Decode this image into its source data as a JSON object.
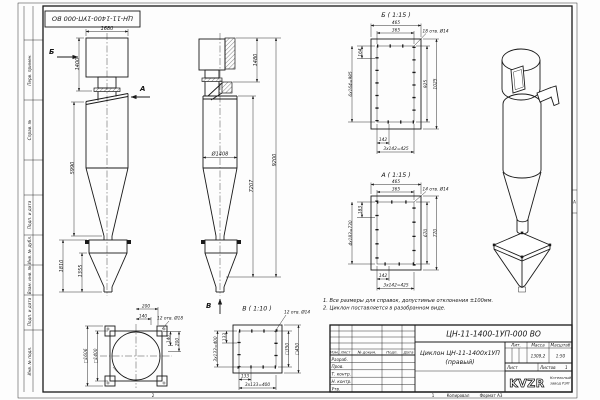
{
  "sheet": {
    "zone_left": "2",
    "zone_mid": "1",
    "zone_side": "А",
    "copied": "Копировал",
    "format": "Формат А3"
  },
  "margin": {
    "cells": [
      "Перв. примен.",
      "Справ. №",
      "Подп. и дата",
      "Инв. № дубл.",
      "Взам. инв. №",
      "Подп. и дата",
      "Инв. № подл."
    ]
  },
  "notes": {
    "line1": "1. Все размеры для справок, допустимые отклонения ±100мм.",
    "line2": "2. Циклон поставляется в разобранном виде."
  },
  "front": {
    "w_top": "1680",
    "h_inlet": "1400",
    "h_body": "5990",
    "h_bunker": "1810",
    "h_bunker_cone": "1355",
    "sec_b": "Б",
    "sec_a": "А"
  },
  "side": {
    "h_top": "1480",
    "dia": "Ø1408",
    "h_mid": "7207",
    "h_total": "9200",
    "sec_v": "В"
  },
  "det_b": {
    "title": "Б ( 1:15 )",
    "holes": "18 отв. Ø14",
    "w1": "465",
    "w2": "365",
    "p1": "164",
    "pv": "6х164=985",
    "h1": "925",
    "h2": "1025",
    "pb1": "142",
    "pb": "3х142=425"
  },
  "det_a": {
    "title": "А ( 1:15 )",
    "holes": "14 отв. Ø14",
    "w1": "465",
    "w2": "365",
    "p1": "183",
    "pv": "4х183=730",
    "h1": "670",
    "h2": "770",
    "pb1": "142",
    "pb": "3х142=425"
  },
  "top_view": {
    "holes": "12 отв. Ø18",
    "o1": "200",
    "o2": "140",
    "r1": "140",
    "r2": "200",
    "s_in": "□1400",
    "s_out": "□1606"
  },
  "det_v": {
    "title": "В ( 1:10 )",
    "holes": "12 отв. Ø14",
    "s_in": "□350",
    "s_out": "□450",
    "p1": "133",
    "pv": "3х133=400",
    "pb1": "133",
    "pb": "3х133=400"
  },
  "tb": {
    "designation": "ЦН-11-1400-1УП-000 ВО",
    "name1": "Циклон ЦН-11-1400х1УП",
    "name2": "(правый)",
    "h_izm": "Изм.",
    "h_list": "Лист",
    "h_doc": "№ докум.",
    "h_podp": "Подп.",
    "h_data": "Дата",
    "rows": [
      "Разраб.",
      "Пров.",
      "Т. контр.",
      "Н. контр.",
      "Утв."
    ],
    "lit": "Лит.",
    "mass_l": "Масса",
    "mass": "1309,2",
    "scale_l": "Масштаб",
    "scale": "1:50",
    "sheet_l": "Лист",
    "sheets_l": "Листов",
    "sheets_n": "1",
    "logo": "KVZR",
    "co1": "Котельный",
    "co2": "завод РЭП"
  }
}
